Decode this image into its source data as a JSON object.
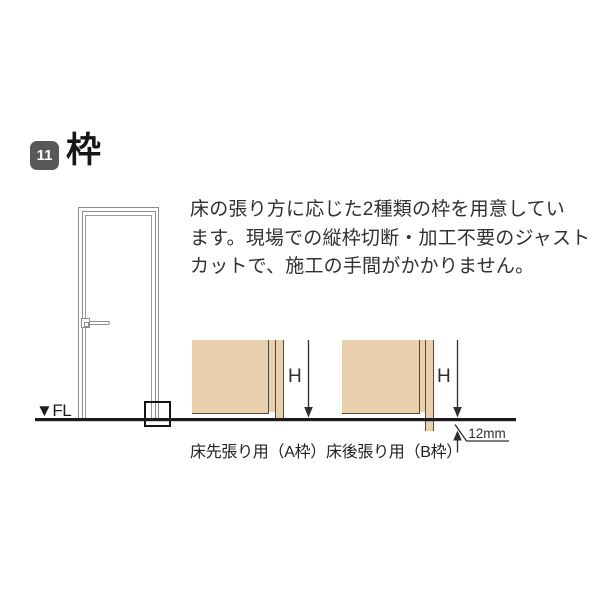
{
  "header": {
    "badge_number": "11",
    "title": "枠"
  },
  "description": {
    "lines": [
      "床の張り方に応じた2種類の枠を用意してい",
      "ます。現場での縦枠切断・加工不要のジャスト",
      "カットで、施工の手間がかかりません。"
    ]
  },
  "door_illustration": {
    "floor_label": "▼FL"
  },
  "diagrams": [
    {
      "id": "A",
      "caption": "床先張り用（A枠）",
      "height_label": "H"
    },
    {
      "id": "B",
      "caption": "床後張り用（B枠）",
      "height_label": "H",
      "offset_label": "12mm"
    }
  ],
  "colors": {
    "wood": "#e9d0ae",
    "wood_outline": "#4d4a40",
    "floor_line": "#1b1b1b",
    "badge_bg": "#585858",
    "door_line": "#8d8d8d"
  }
}
